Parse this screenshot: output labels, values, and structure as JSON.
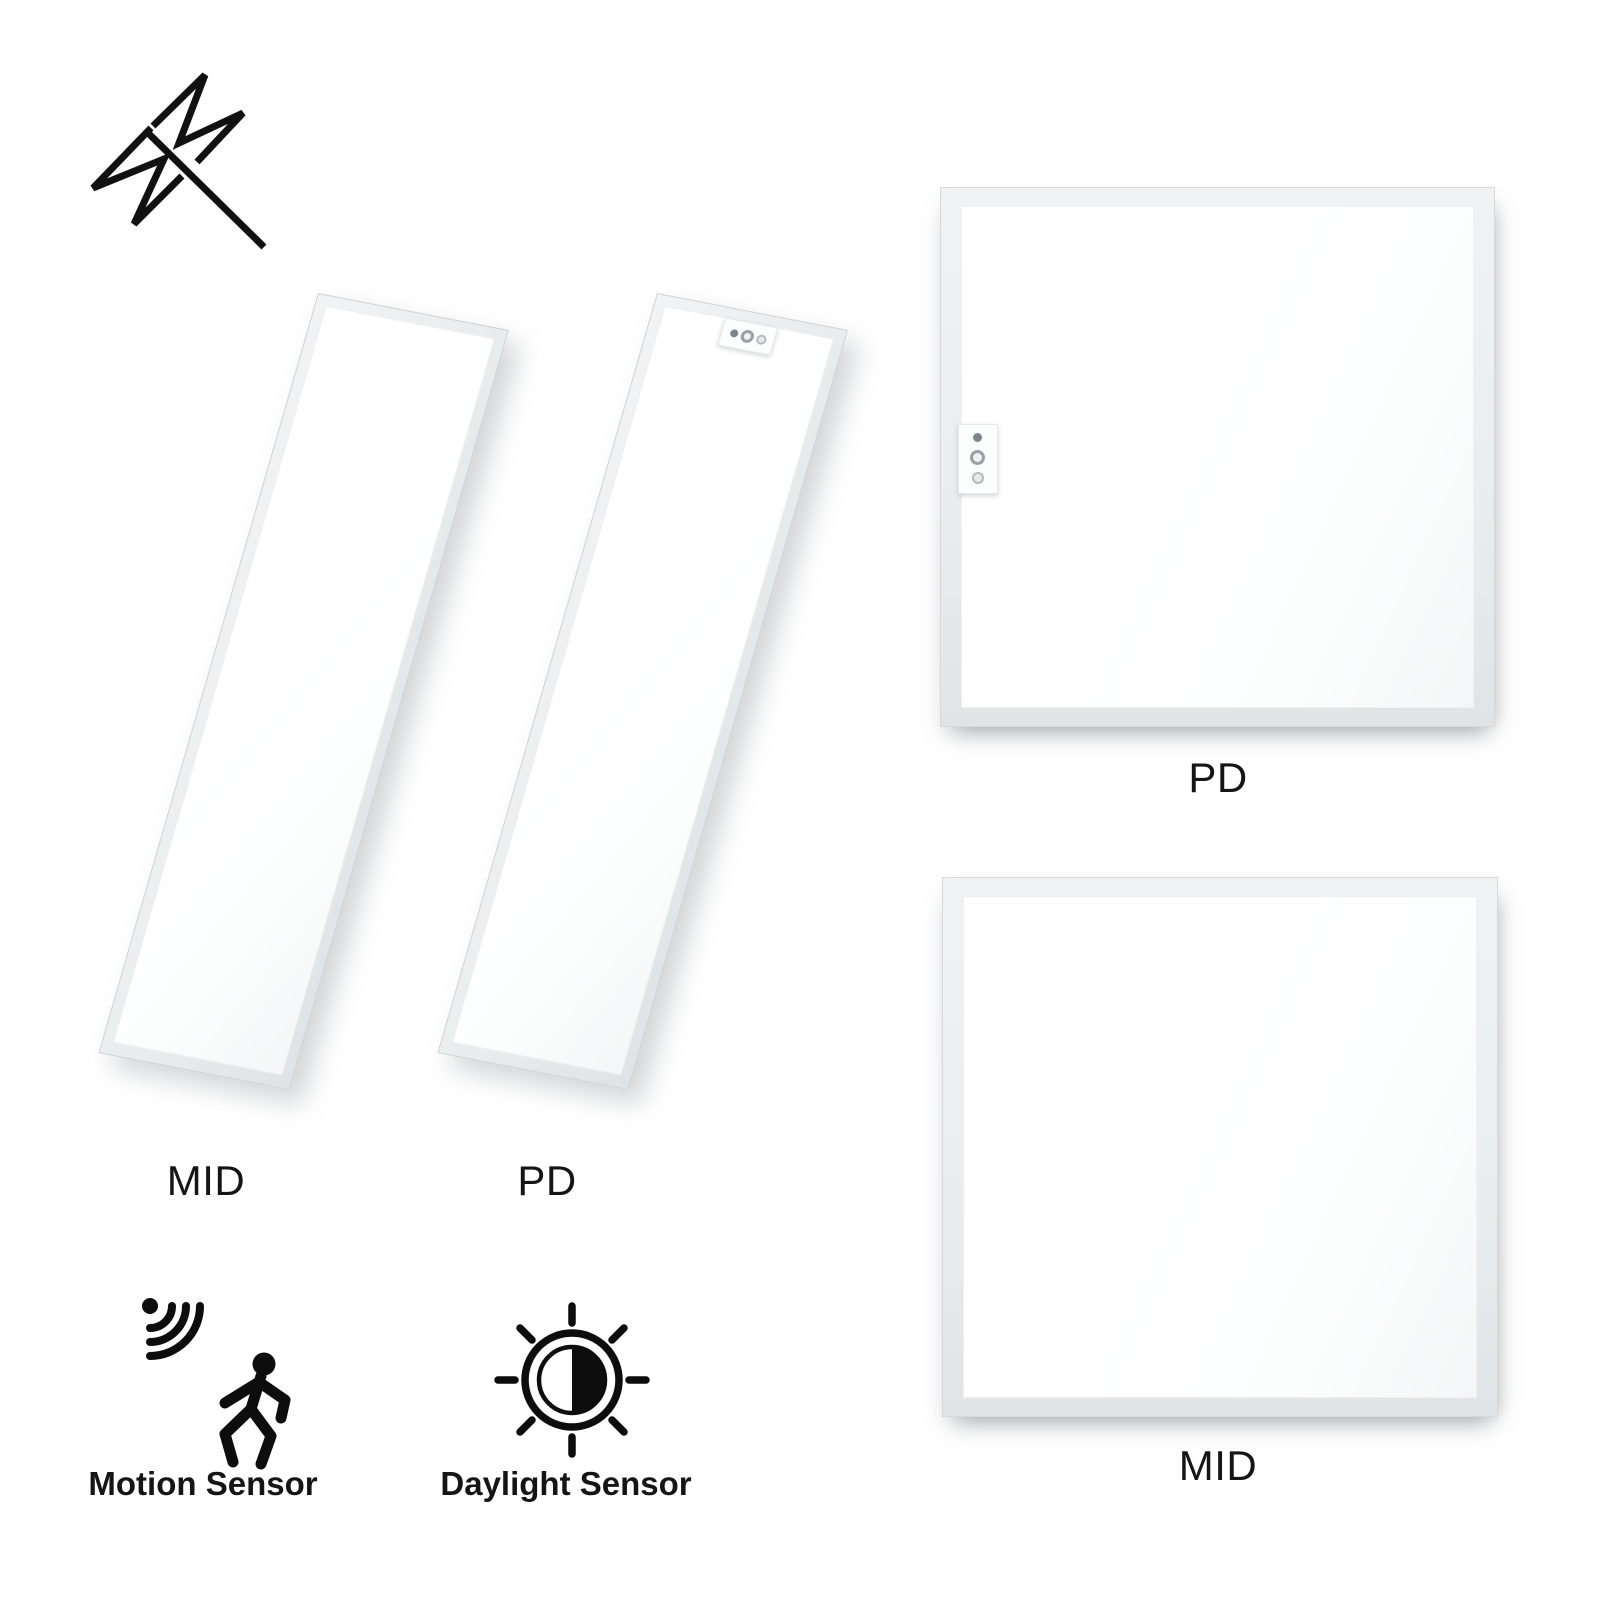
{
  "page": {
    "background": "#ffffff"
  },
  "panels": [
    {
      "type": "linear-tilted",
      "label": "MID",
      "has_sensor": false
    },
    {
      "type": "linear-tilted",
      "label": "PD",
      "has_sensor": true
    },
    {
      "type": "square",
      "label": "PD",
      "has_sensor": true
    },
    {
      "type": "square",
      "label": "MID",
      "has_sensor": false
    }
  ],
  "features": [
    {
      "icon": "motion-sensor-icon",
      "label": "Motion Sensor"
    },
    {
      "icon": "daylight-sensor-icon",
      "label": "Daylight Sensor"
    }
  ],
  "badges": [
    {
      "icon": "no-flicker-icon"
    }
  ],
  "colors": {
    "panel_frame": "#eaedee",
    "panel_frame_edge": "#ccd1d5",
    "panel_face": "#ffffff",
    "sensor_dot_dark": "#7d848a",
    "sensor_dot_ring": "#9aa0a5",
    "icon_ink": "#0d0d0d",
    "label_text": "#151515"
  }
}
